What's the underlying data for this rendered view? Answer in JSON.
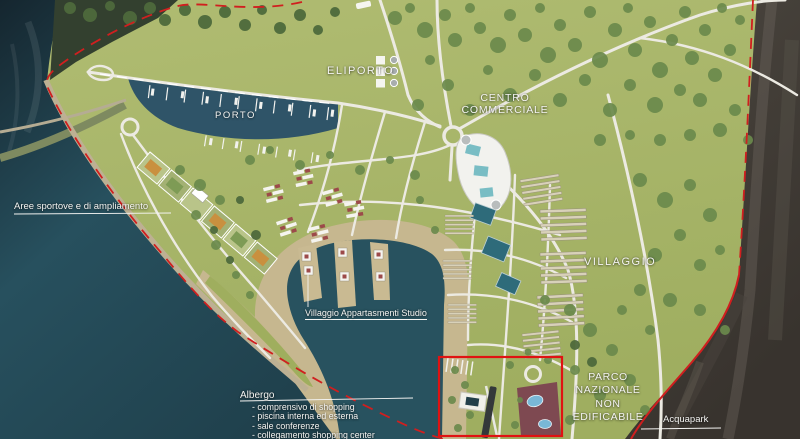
{
  "labels": {
    "eliporto": "ELIPORTO",
    "porto": "PORTO",
    "centro_commerciale": {
      "line1": "CENTRO",
      "line2": "COMMERCIALE"
    },
    "villaggio": "VILLAGGIO",
    "parco": {
      "line1": "PARCO",
      "line2": "NAZIONALE",
      "line3": "NON",
      "line4": "EDIFICABILE"
    },
    "acquapark": "Acquapark",
    "aree_sportive": "Aree sportove e di ampliamento",
    "villaggio_appartamenti": "Villaggio Appartasmenti Studio",
    "albergo": {
      "title": "Albergo",
      "items": [
        "- comprensivo di shopping",
        "- piscina interna ed esterna",
        "- sale conferenze",
        "- collegamento shopping center"
      ]
    }
  },
  "colors": {
    "sea": "#1f3d4a",
    "land_green": "#a9b566",
    "sand": "#c6b78f",
    "boundary_red": "#d01f1f",
    "highlight_red": "#e01212",
    "road_white": "#eceae2"
  }
}
